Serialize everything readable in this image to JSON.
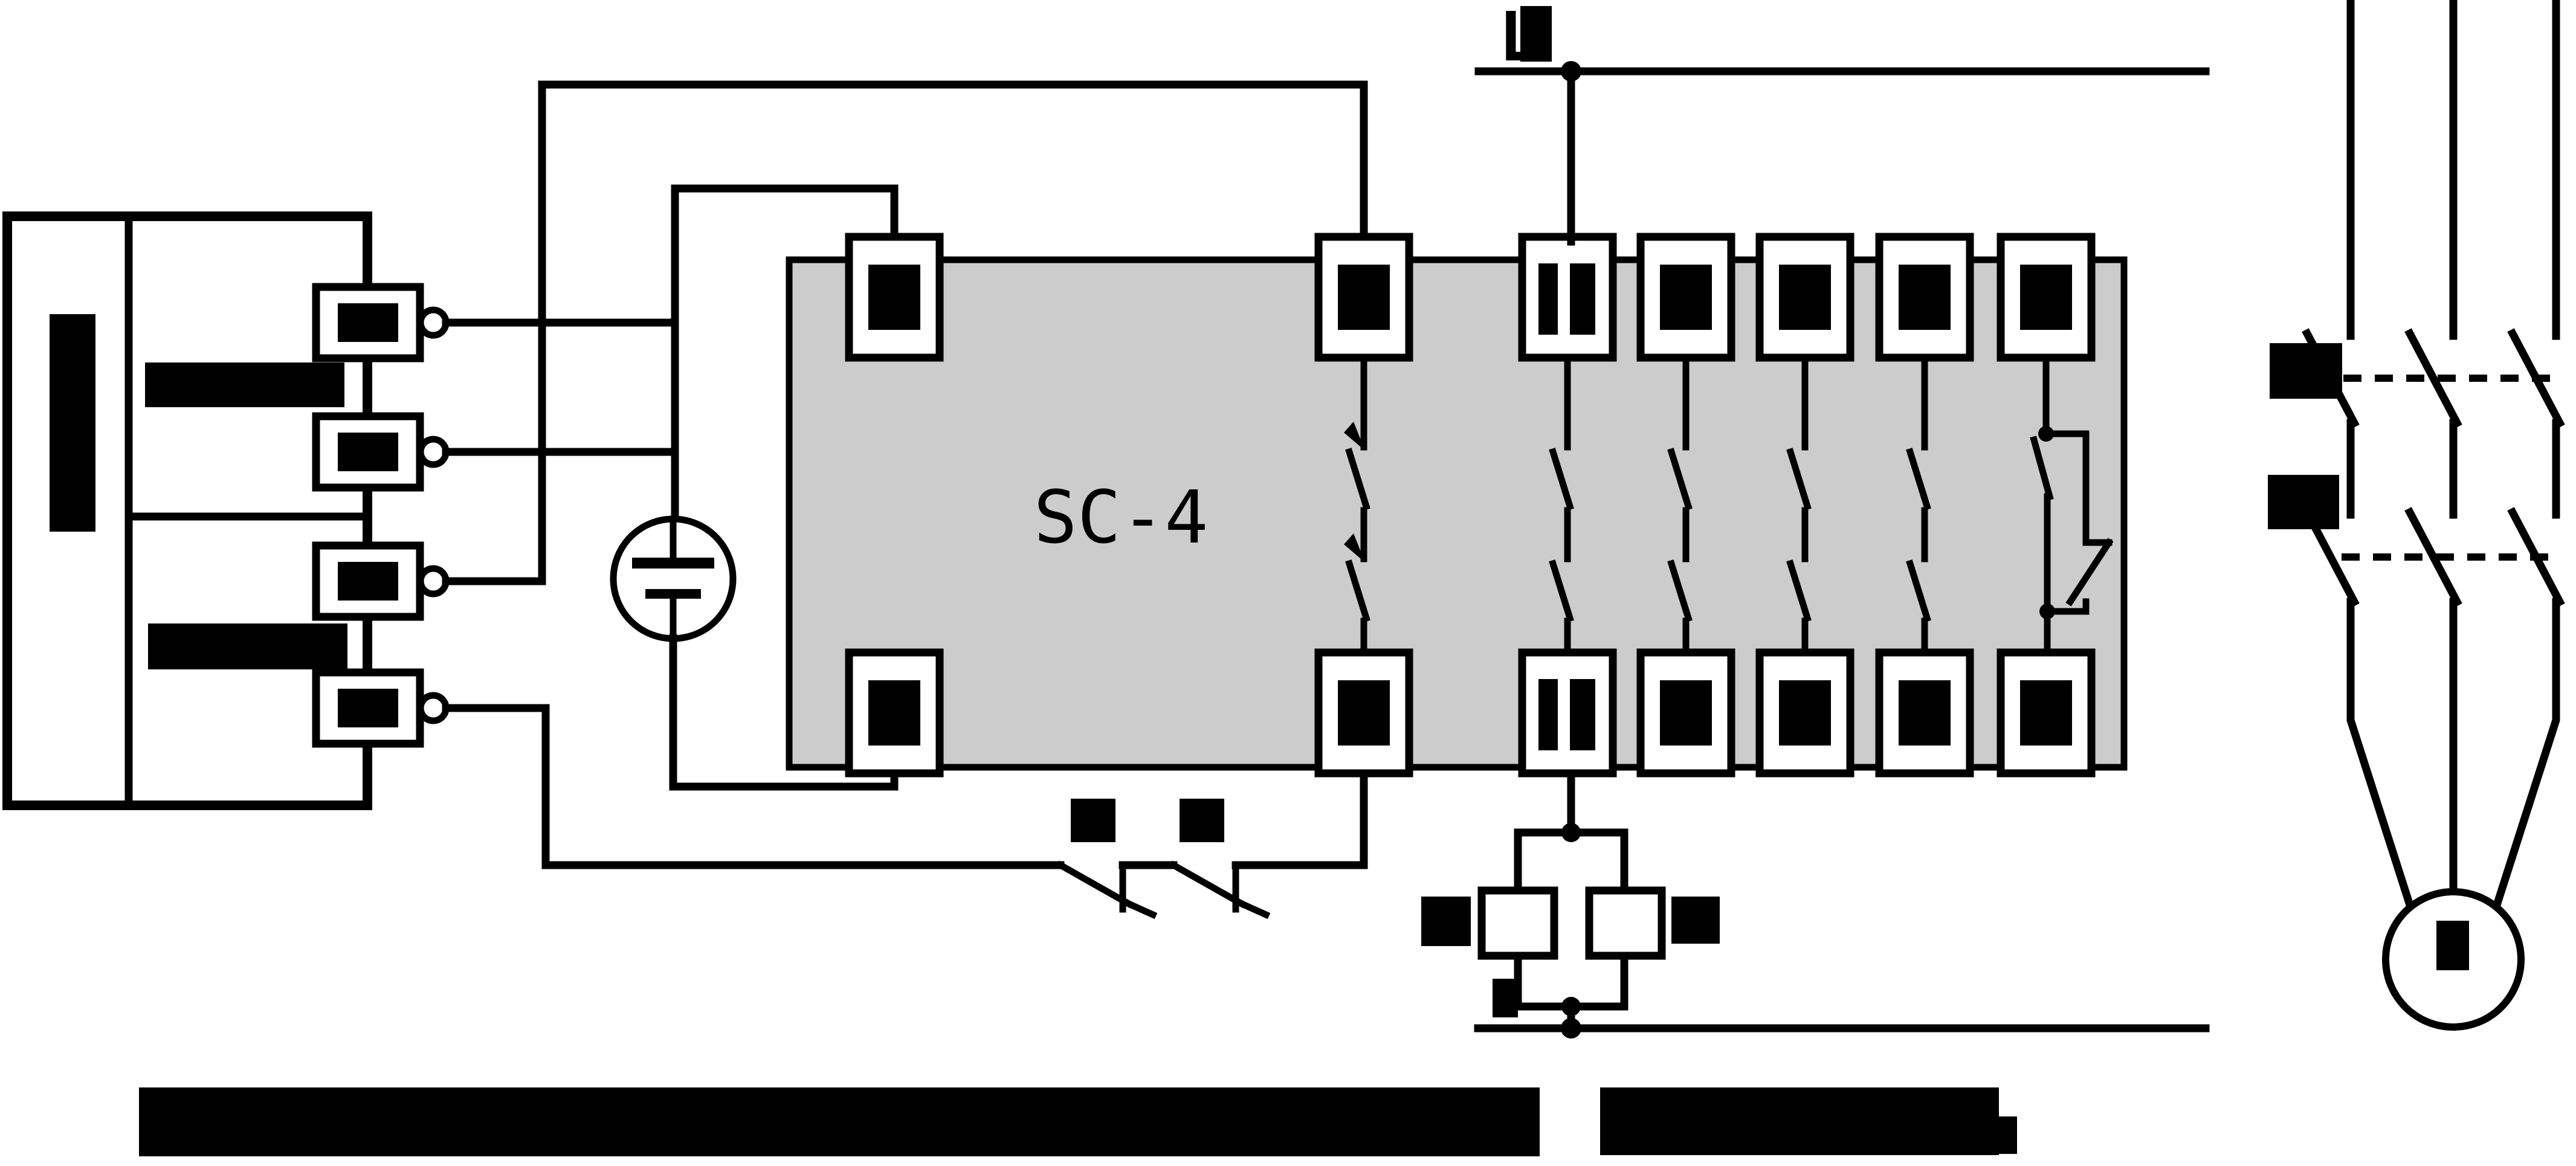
{
  "diagram": {
    "relay_label": "SC-4",
    "line_label": "L"
  },
  "colors": {
    "stroke": "#000000",
    "relay_fill": "#cccccc",
    "background": "#ffffff",
    "redaction": "#000000"
  }
}
